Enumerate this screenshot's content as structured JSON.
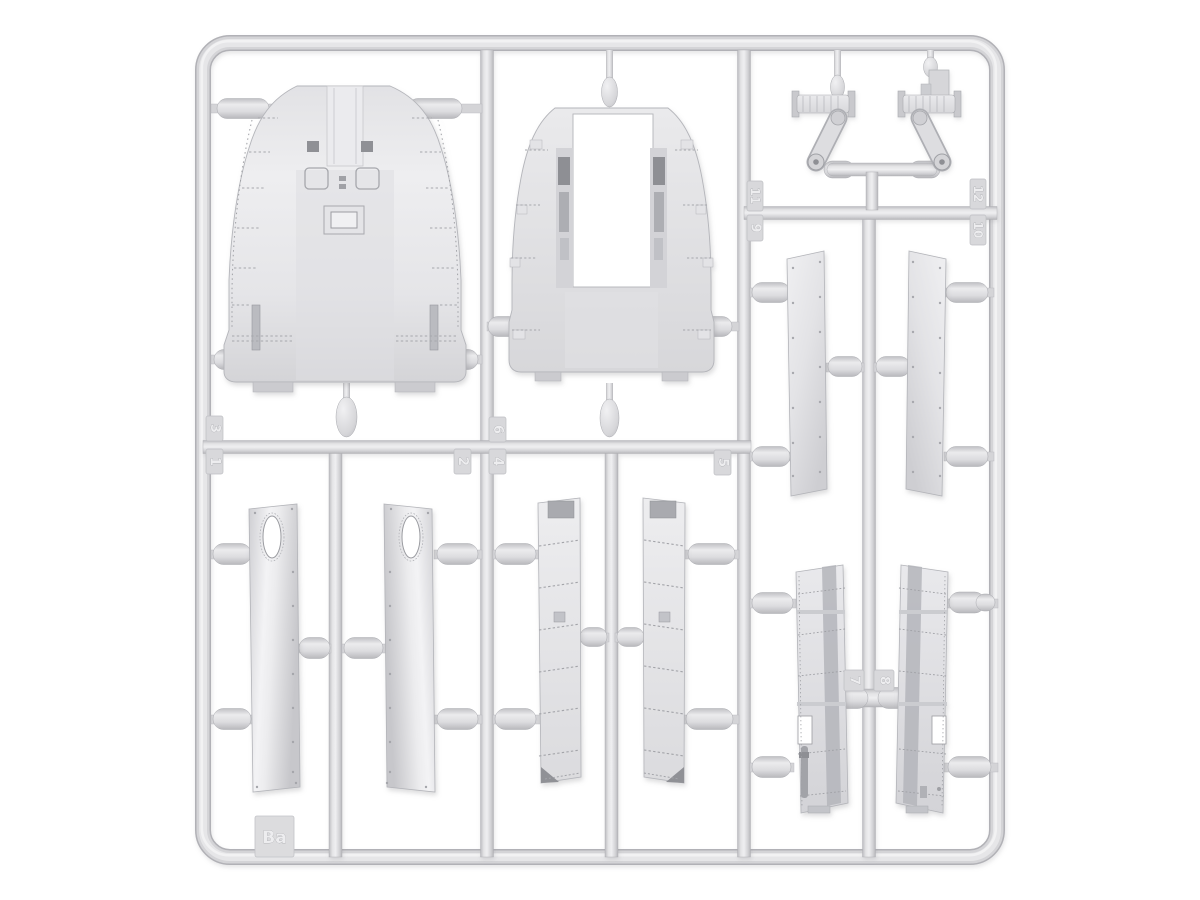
{
  "sprue": {
    "label": "Ba",
    "plastic_color": "#d9d9db",
    "background_color": "#ffffff",
    "tags": {
      "t1": "1",
      "t2": "2",
      "t3": "3",
      "t4": "4",
      "t5": "5",
      "t6": "6",
      "t7": "7",
      "t8": "8",
      "t9": "9",
      "t10": "10",
      "t11": "11",
      "t12": "12"
    }
  }
}
